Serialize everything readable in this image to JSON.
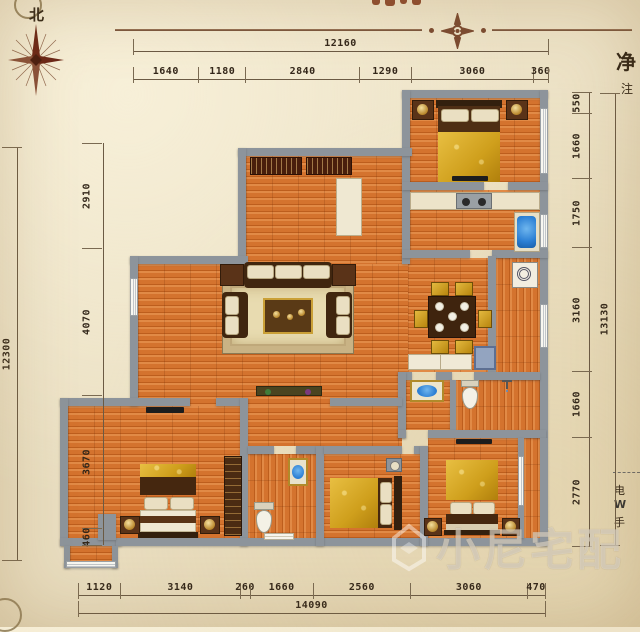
{
  "compass": {
    "north": "北"
  },
  "annotations": {
    "net": "净",
    "note": "注",
    "contact": [
      "电",
      "W",
      "手"
    ]
  },
  "watermark": {
    "text": "小尼宅配"
  },
  "dimensions": {
    "top": {
      "overall": "12160",
      "segments": [
        "1640",
        "1180",
        "2840",
        "1290",
        "3060",
        "360"
      ]
    },
    "bottom": {
      "overall": "14090",
      "segments": [
        "1120",
        "3140",
        "260",
        "1660",
        "2560",
        "3060",
        "470"
      ]
    },
    "left": {
      "overall": "12300",
      "segments": [
        "2910",
        "4070",
        "3670",
        "460"
      ]
    },
    "right": {
      "overall": "13130",
      "segments": [
        "550",
        "1660",
        "1750",
        "3160",
        "1660",
        "2770"
      ]
    }
  },
  "colors": {
    "wall": "#8d949b",
    "floor": "#d4732e",
    "gold": "#caa037",
    "sink_blue": "#2b7fd4",
    "parchment": "#ece1c6"
  }
}
